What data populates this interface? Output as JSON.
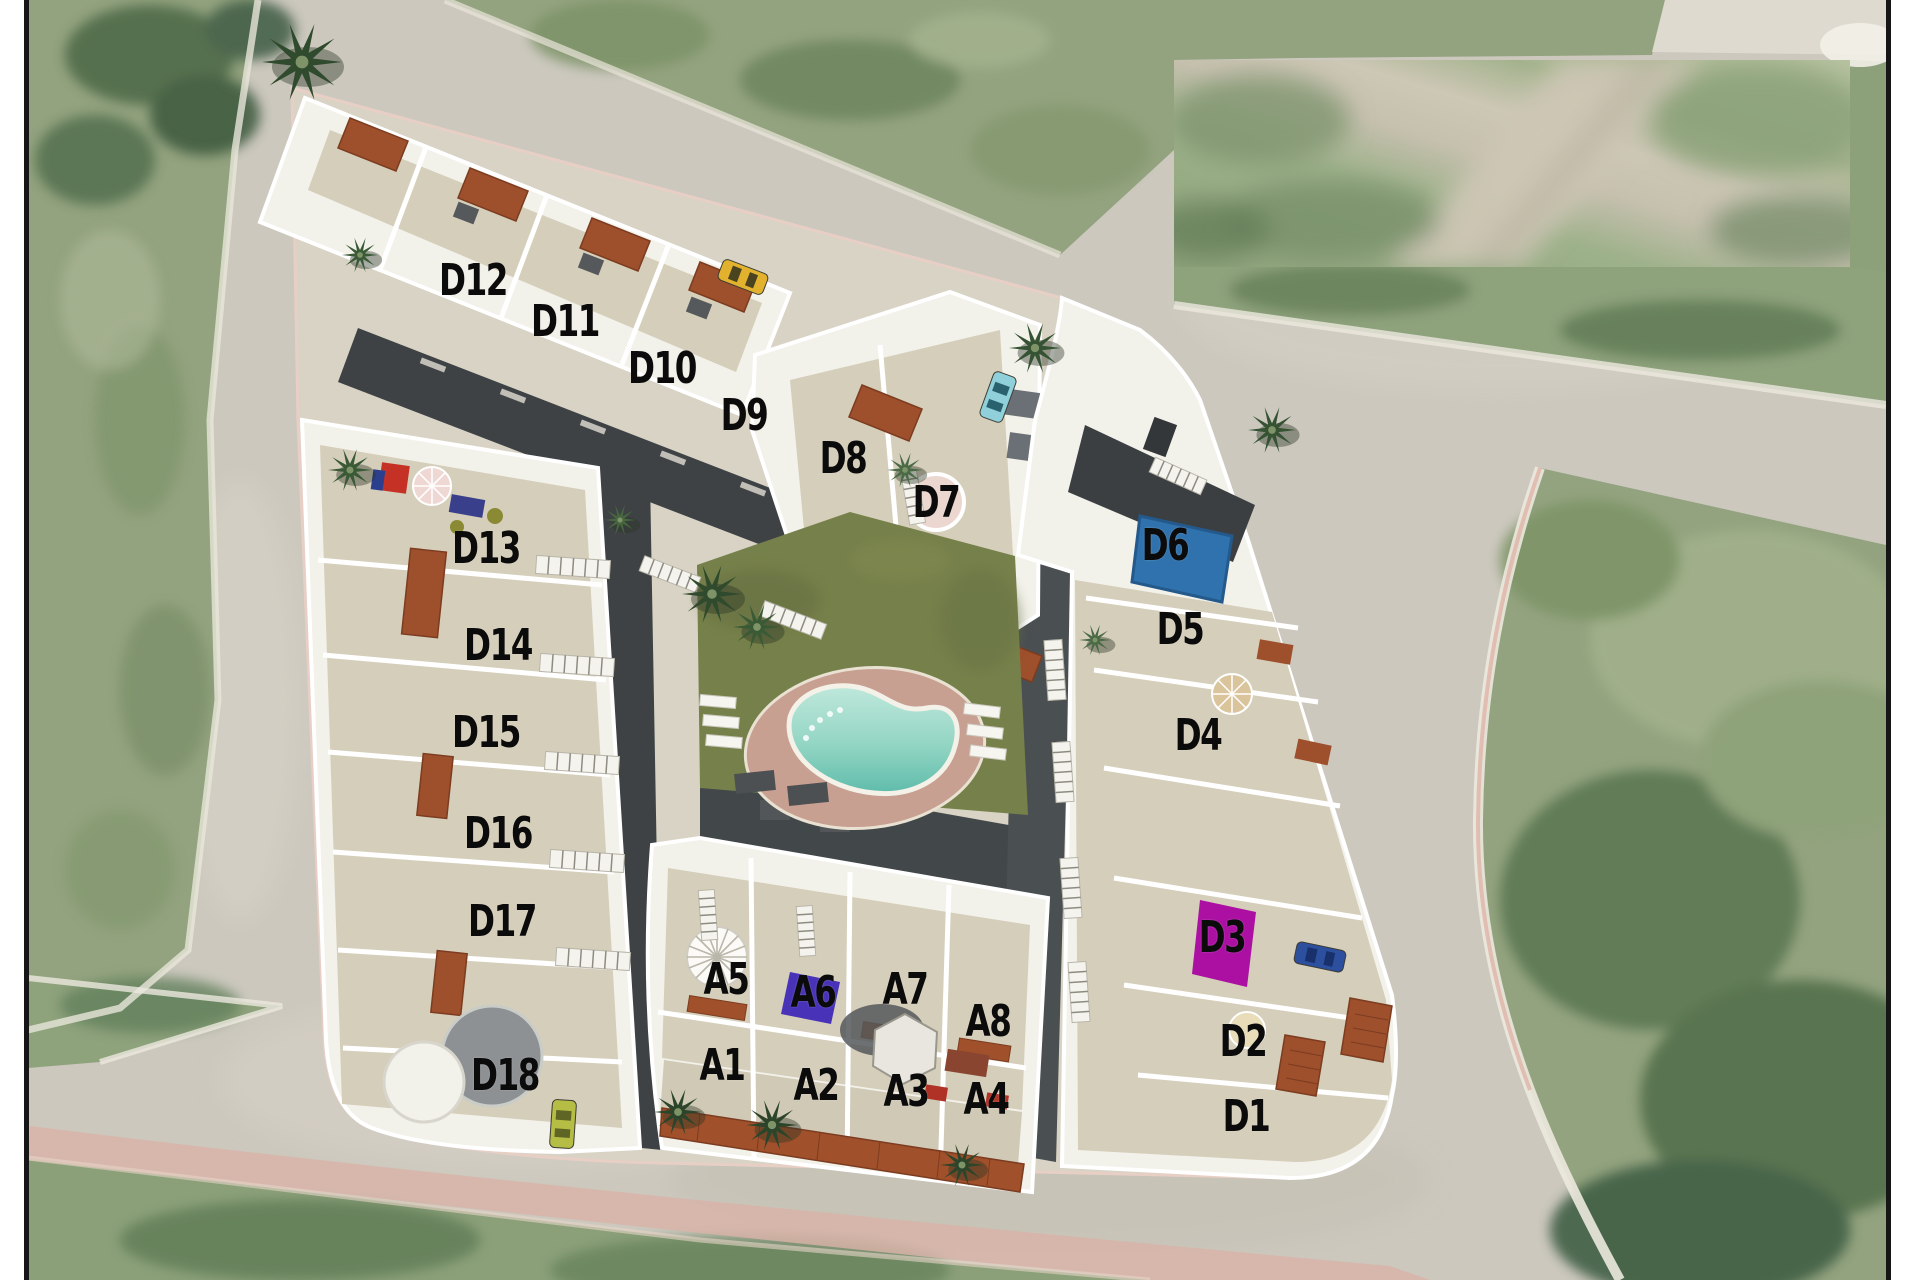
{
  "scene": {
    "units": [
      {
        "id": "D12"
      },
      {
        "id": "D11"
      },
      {
        "id": "D10"
      },
      {
        "id": "D9"
      },
      {
        "id": "D8"
      },
      {
        "id": "D7"
      },
      {
        "id": "D13"
      },
      {
        "id": "D14"
      },
      {
        "id": "D15"
      },
      {
        "id": "D16"
      },
      {
        "id": "D17"
      },
      {
        "id": "D18"
      },
      {
        "id": "A5"
      },
      {
        "id": "A6"
      },
      {
        "id": "A7"
      },
      {
        "id": "A8"
      },
      {
        "id": "A1"
      },
      {
        "id": "A2"
      },
      {
        "id": "A3"
      },
      {
        "id": "A4"
      },
      {
        "id": "D6"
      },
      {
        "id": "D5"
      },
      {
        "id": "D4"
      },
      {
        "id": "D3"
      },
      {
        "id": "D2"
      },
      {
        "id": "D1"
      }
    ],
    "colors": {
      "label_text": "#0b0b0b",
      "d6_roof_pool": "#2f72ad",
      "d3_marker": "#ab10a2",
      "a6_marker": "#4833b8",
      "pool_water_light": "#b9e6d8",
      "pool_water_deep": "#6fc4b0",
      "pool_deck": "#c8a092",
      "lawn": "#76804a",
      "road": "#ccc8be",
      "vegetation": "#93a37f",
      "tile_roof": "#9e4f2c",
      "building_wall": "#f2f1ea",
      "terrace": "#d5ceba",
      "dark_roof": "#3e4245",
      "pink_path": "#d9b3a8",
      "car_yellow": "#e2b22e",
      "car_cyan": "#8fd0da",
      "car_blue": "#2c4f9e",
      "car_green": "#b5bd44",
      "d7_spa_circle": "#ecd6d0"
    }
  }
}
